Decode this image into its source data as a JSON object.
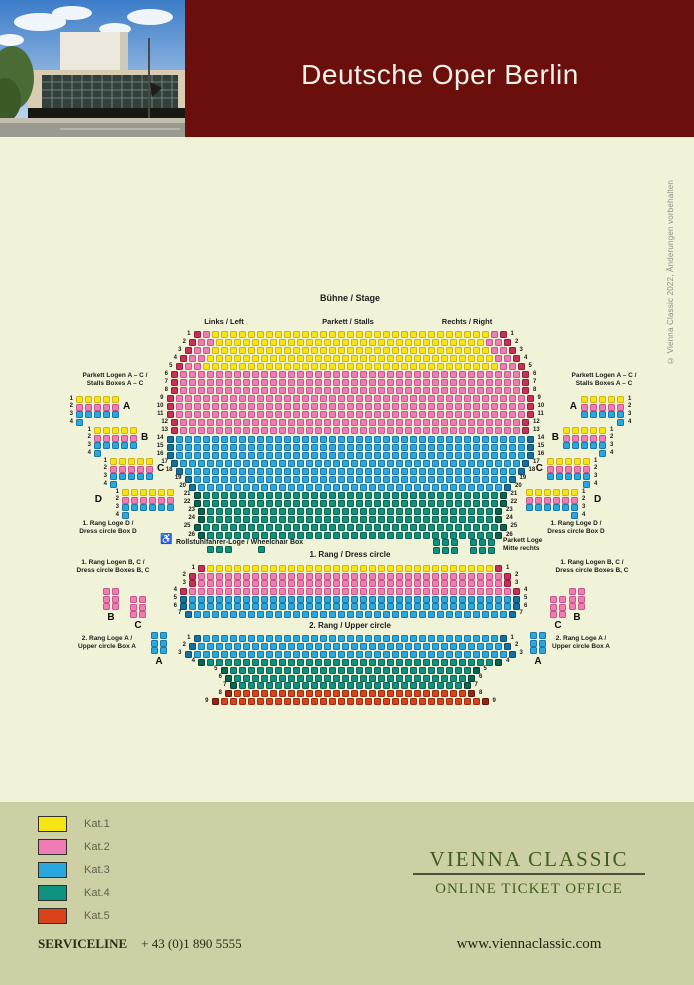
{
  "page": {
    "bg": "#f1f3d9",
    "header_bg": "#6b0f0d",
    "footer_bg": "#cdd0a4"
  },
  "header": {
    "title": "Deutsche Oper Berlin"
  },
  "copyright": "© Vienna Classic 2022, Änderungen vorbehalten",
  "map": {
    "stage": "Bühne / Stage",
    "links": "Links / Left",
    "parkett_stalls": "Parkett / Stalls",
    "rechts": "Rechts / Right",
    "rang1_title": "1. Rang / Dress circle",
    "rang2_title": "2. Rang / Upper circle",
    "wheelchair_icon": "♿",
    "wheelchair_label": "Rollstuhlfahrer-Loge / Wheelchair Box",
    "parkett_loge_label": [
      "Parkett Loge",
      "Mitte rechts"
    ],
    "stalls_boxes_label": [
      "Parkett Logen A – C /",
      "Stalls Boxes A – C"
    ],
    "box_d_label": [
      "1. Rang Loge D /",
      "Dress circle Box D"
    ],
    "rang1_boxes_label": [
      "1. Rang Logen B, C /",
      "Dress circle Boxes B, C"
    ],
    "rang2_box_label": [
      "2. Rang Loge A /",
      "Upper circle Box A"
    ],
    "palette": {
      "Y": {
        "fill": "#f7e513",
        "border": "#cfb41c"
      },
      "P": {
        "fill": "#f07cb4",
        "border": "#c9568e"
      },
      "B": {
        "fill": "#2aa7de",
        "border": "#1878aa"
      },
      "T": {
        "fill": "#0f9180",
        "border": "#0a6457"
      },
      "R": {
        "fill": "#da421c",
        "border": "#9c2d10"
      },
      "E": {
        "fill": "#c8305b",
        "border": "#8f1f3e"
      },
      "N": {
        "fill": "#1470a0",
        "border": "#0c4e71"
      },
      "M": {
        "fill": "#076653",
        "border": "#053f33"
      },
      "D": {
        "fill": "#9a2410",
        "border": "#5f150a"
      }
    },
    "sections": {
      "parkett": {
        "y": 331,
        "pitch": 8.04,
        "rows": [
          {
            "n": 1,
            "pat": "E1 P1 Y31 P1 E1"
          },
          {
            "n": 2,
            "pat": "E1 P2 Y30 P2 E1"
          },
          {
            "n": 3,
            "pat": "E1 P2 Y31 P2 E1"
          },
          {
            "n": 4,
            "pat": "E1 P2 Y32 P2 E1"
          },
          {
            "n": 5,
            "pat": "E1 P2 Y33 P2 E1"
          },
          {
            "n": 6,
            "pat": "E1 P38 E1"
          },
          {
            "n": 7,
            "pat": "E1 P38 E1"
          },
          {
            "n": 8,
            "pat": "E1 P38 E1"
          },
          {
            "n": 9,
            "pat": "E1 P39 E1"
          },
          {
            "n": 10,
            "pat": "E1 P39 E1"
          },
          {
            "n": 11,
            "pat": "E1 P39 E1"
          },
          {
            "n": 12,
            "pat": "E1 P38 E1"
          },
          {
            "n": 13,
            "pat": "E1 P38 E1"
          },
          {
            "n": 14,
            "pat": "N1 B39 N1"
          },
          {
            "n": 15,
            "pat": "N1 B39 N1"
          },
          {
            "n": 16,
            "pat": "N1 B39 N1"
          },
          {
            "n": 17,
            "pat": "N1 B38 N1"
          },
          {
            "n": 18,
            "pat": "N1 B37 N1"
          },
          {
            "n": 19,
            "pat": "N1 B35 N1"
          },
          {
            "n": 20,
            "pat": "N1 B34 N1"
          },
          {
            "n": 21,
            "pat": "M1 T33 M1"
          },
          {
            "n": 22,
            "pat": "M1 T33 M1"
          },
          {
            "n": 23,
            "pat": "M1 T32 M1"
          },
          {
            "n": 24,
            "pat": "M1 T32 M1"
          },
          {
            "n": 25,
            "pat": "M1 T33 M1"
          },
          {
            "n": 26,
            "pat": "M1 T32 M1"
          }
        ]
      },
      "rang1": {
        "y": 565,
        "pitch": 7.65,
        "rows": [
          {
            "n": 1,
            "pat": "E1 Y32 E1"
          },
          {
            "n": 2,
            "pat": "E1 P34 E1"
          },
          {
            "n": 3,
            "pat": "E1 P34 E1"
          },
          {
            "n": 4,
            "pat": "E1 P36 E1"
          },
          {
            "n": 5,
            "pat": "N1 B36 N1"
          },
          {
            "n": 6,
            "pat": "N1 B36 N1"
          },
          {
            "n": 7,
            "pat": "N1 B35 N1"
          }
        ]
      },
      "rang2": {
        "y": 635,
        "pitch": 7.9,
        "rows": [
          {
            "n": 1,
            "pat": "N1 B33 N1"
          },
          {
            "n": 2,
            "pat": "N1 B34 N1"
          },
          {
            "n": 3,
            "pat": "N1 B35 N1"
          },
          {
            "n": 4,
            "pat": "M1 T32 M1"
          },
          {
            "n": 5,
            "pat": "M1 T27 M1"
          },
          {
            "n": 6,
            "pat": "M1 T26 M1"
          },
          {
            "n": 7,
            "pat": "M1 T25 M1"
          },
          {
            "n": 8,
            "pat": "D1 R26 D1"
          },
          {
            "n": 9,
            "pat": "D1 R29 D1"
          }
        ]
      }
    },
    "stall_boxes": [
      {
        "letter": "A",
        "x": 76,
        "y": 396,
        "rows": [
          "Y5",
          "P5",
          "B5",
          "B1"
        ],
        "letter_side": "right",
        "num_side": "left",
        "single": "left"
      },
      {
        "letter": "B",
        "x": 94,
        "y": 427,
        "rows": [
          "Y5",
          "P5",
          "B5",
          "B1"
        ],
        "letter_side": "right",
        "num_side": "left",
        "single": "left"
      },
      {
        "letter": "C",
        "x": 110,
        "y": 458,
        "rows": [
          "Y5",
          "P5",
          "B5",
          "B1"
        ],
        "letter_side": "right",
        "num_side": "left",
        "single": "left"
      },
      {
        "letter": "D",
        "x": 122,
        "y": 489,
        "rows": [
          "Y6",
          "P6",
          "B6",
          "B1"
        ],
        "letter_side": "left",
        "num_side": "left",
        "single": "left"
      },
      {
        "letter": "A",
        "x": 581,
        "y": 396,
        "rows": [
          "Y5",
          "P5",
          "B5",
          "B1"
        ],
        "letter_side": "left",
        "num_side": "right",
        "single": "right"
      },
      {
        "letter": "B",
        "x": 563,
        "y": 427,
        "rows": [
          "Y5",
          "P5",
          "B5",
          "B1"
        ],
        "letter_side": "left",
        "num_side": "right",
        "single": "right"
      },
      {
        "letter": "C",
        "x": 547,
        "y": 458,
        "rows": [
          "Y5",
          "P5",
          "B5",
          "B1"
        ],
        "letter_side": "left",
        "num_side": "right",
        "single": "right"
      },
      {
        "letter": "D",
        "x": 526,
        "y": 489,
        "rows": [
          "Y6",
          "P6",
          "B6",
          "B1"
        ],
        "letter_side": "right",
        "num_side": "right",
        "single": "right"
      }
    ],
    "rang_boxes": [
      {
        "letter": "B",
        "x": 103,
        "y": 588,
        "code": "P"
      },
      {
        "letter": "C",
        "x": 130,
        "y": 596,
        "code": "P"
      },
      {
        "letter": "A",
        "x": 151,
        "y": 632,
        "code": "B"
      },
      {
        "letter": "B",
        "x": 569,
        "y": 588,
        "code": "P"
      },
      {
        "letter": "C",
        "x": 550,
        "y": 596,
        "code": "P"
      },
      {
        "letter": "A",
        "x": 530,
        "y": 632,
        "code": "B"
      }
    ],
    "seat_groups": [
      {
        "x": 207,
        "y": 546,
        "cols": 3,
        "rows": 1,
        "code": "T"
      },
      {
        "x": 258,
        "y": 546,
        "cols": 1,
        "rows": 1,
        "code": "T"
      },
      {
        "x": 433,
        "y": 539,
        "cols": 3,
        "rows": 2,
        "code": "T"
      },
      {
        "x": 470,
        "y": 539,
        "cols": 3,
        "rows": 2,
        "code": "T"
      }
    ]
  },
  "legend": {
    "items": [
      {
        "label": "Kat.1",
        "color": "#f7e513"
      },
      {
        "label": "Kat.2",
        "color": "#f07cb4"
      },
      {
        "label": "Kat.3",
        "color": "#2aa7de"
      },
      {
        "label": "Kat.4",
        "color": "#0f9180"
      },
      {
        "label": "Kat.5",
        "color": "#da421c"
      }
    ]
  },
  "footer": {
    "brand": "VIENNA CLASSIC",
    "tagline": "ONLINE TICKET OFFICE",
    "serviceline_label": "SERVICELINE",
    "phone": "+ 43 (0)1 890 5555",
    "website": "www.viennaclassic.com"
  }
}
